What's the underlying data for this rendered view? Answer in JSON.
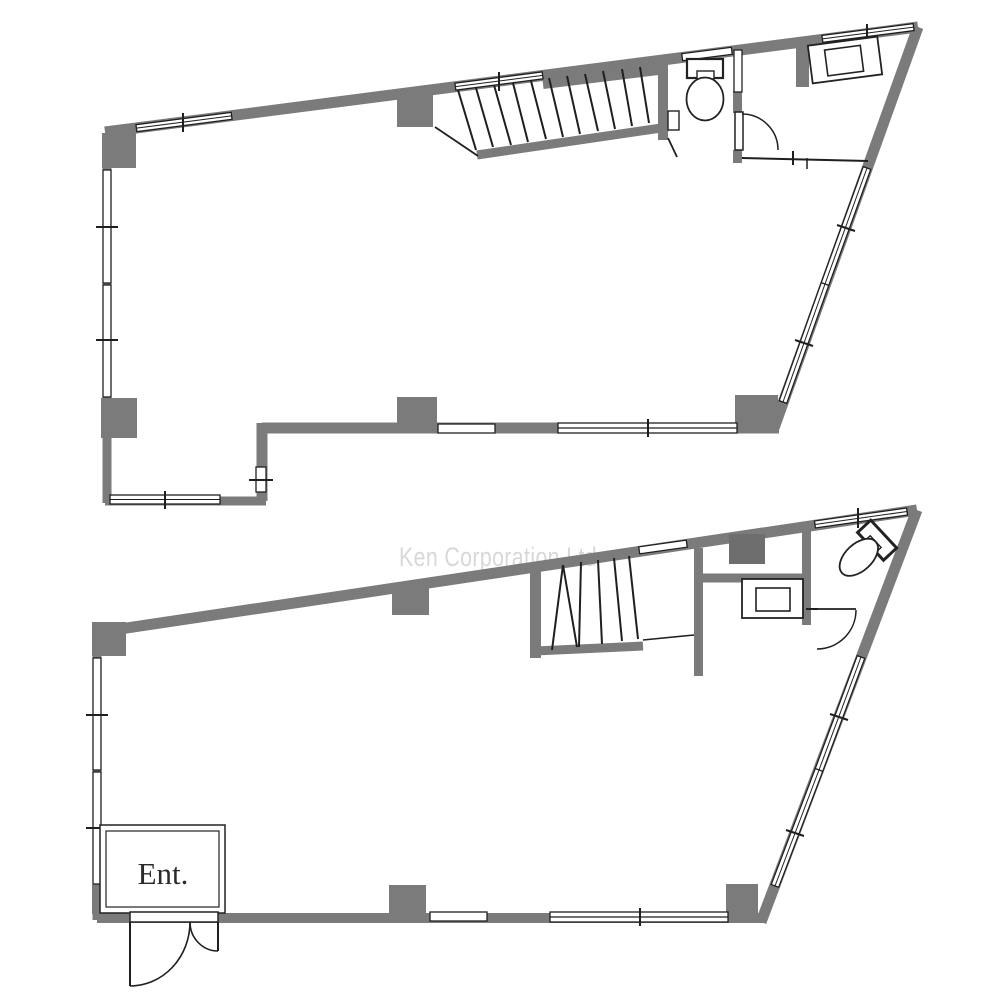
{
  "watermark": {
    "text": "Ken Corporation Ltd"
  },
  "lower_floor": {
    "entrance_label": "Ent."
  },
  "rooms": {
    "upper": [
      "staircase",
      "toilet-room",
      "washbasin-area",
      "open-floor"
    ],
    "lower": [
      "staircase",
      "washbasin-room",
      "toilet-room",
      "entrance",
      "open-floor"
    ]
  },
  "colors": {
    "wall": "#7b7b7b",
    "line": "#1f1f1f",
    "watermark": "#d8d8d8",
    "background": "#ffffff"
  }
}
